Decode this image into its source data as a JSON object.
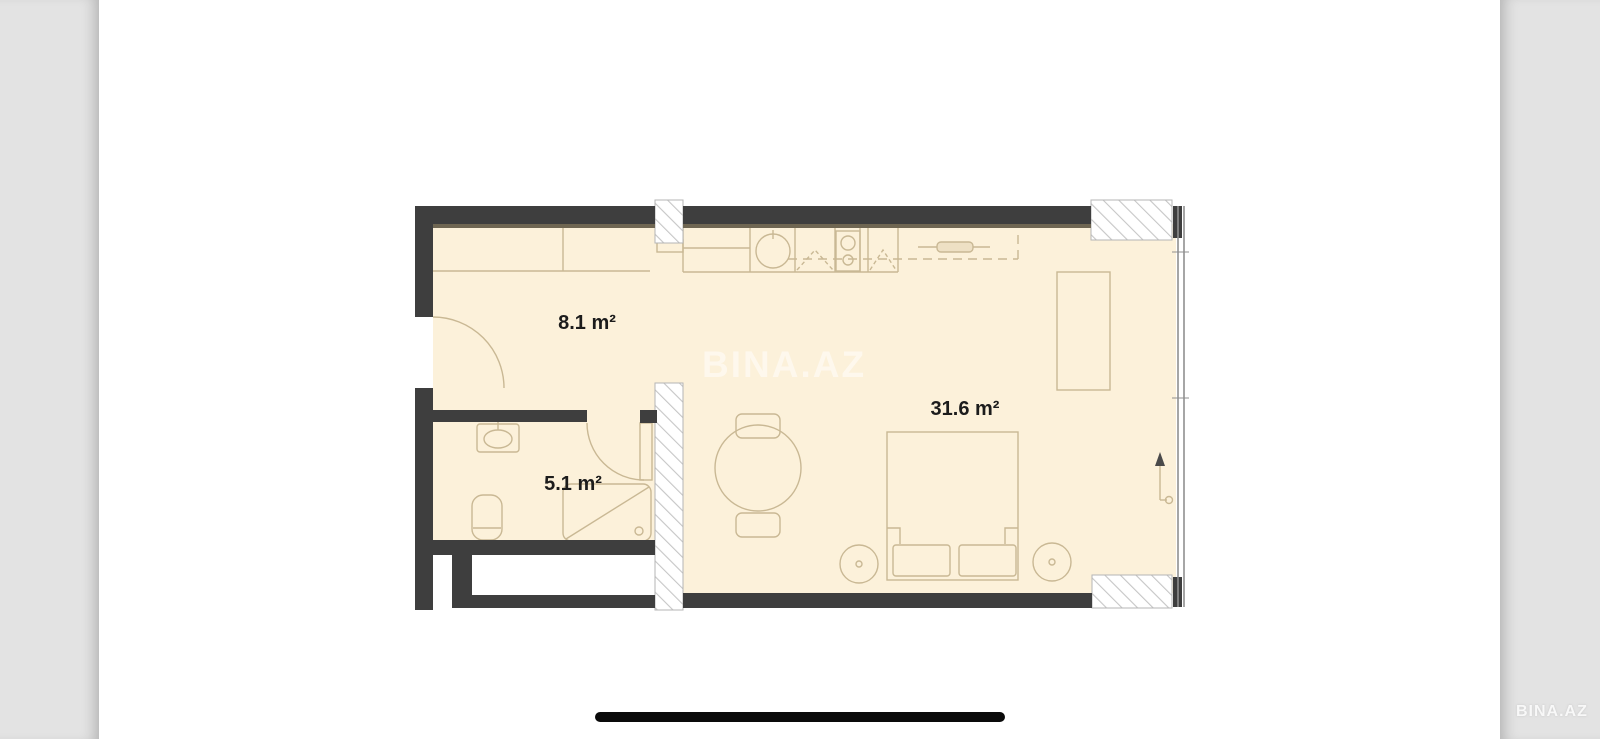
{
  "viewer": {
    "type": "mobile-photo-viewer",
    "gutter_color": "#e3e3e3",
    "page_color": "#ffffff",
    "home_indicator_color": "#0a0a0a"
  },
  "watermark": {
    "center_text": "BINA.AZ",
    "corner_text": "BINA.AZ"
  },
  "floor_plan": {
    "rooms": [
      {
        "name": "hall",
        "area_label": "8.1 m²"
      },
      {
        "name": "bathroom",
        "area_label": "5.1 m²"
      },
      {
        "name": "living-kitchen",
        "area_label": "31.6 m²"
      }
    ],
    "colors": {
      "wall": "#3e3e3e",
      "wall_shadow": "#6f6652",
      "floor": "#fcf1da",
      "furniture_outline": "#c9b894",
      "hatch_line": "#c6c6c6",
      "hatch_border": "#b5b5b5",
      "window": "#8f8f8f",
      "label_text": "#1c1c1c"
    },
    "elements": [
      "entrance-door",
      "hall-closet",
      "bathroom-door",
      "washbasin",
      "toilet",
      "shower",
      "kitchen-counter",
      "kitchen-sink",
      "stove",
      "upper-cabinets",
      "kitchen-rail",
      "wardrobe",
      "dining-table",
      "chair",
      "chair",
      "bed",
      "pillow",
      "pillow",
      "nightstand",
      "nightstand",
      "entry-arrow",
      "window-wall",
      "hatched-wall-sections"
    ]
  }
}
